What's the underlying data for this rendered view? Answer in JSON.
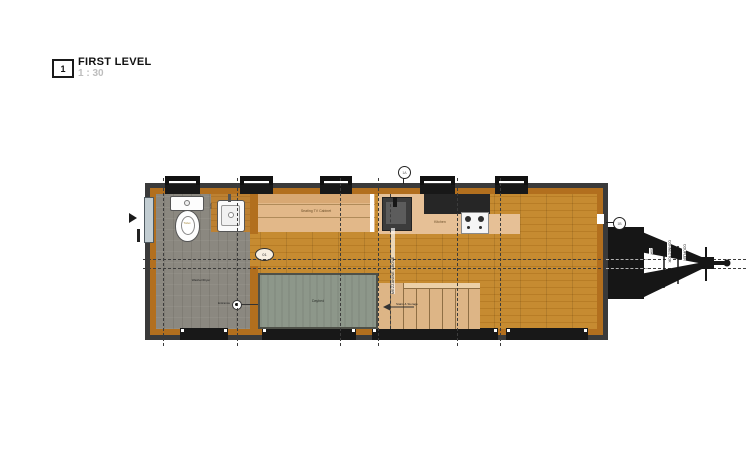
{
  "sheet": {
    "number": "1",
    "title": "FIRST LEVEL",
    "scale": "1 : 30"
  },
  "plan": {
    "labels": {
      "toilet": "Toilet",
      "sink": "Sink",
      "washer_dryer": "Washer/Dryer",
      "entrance": "Entrance",
      "fixture_tag": "01",
      "seating": "Seating TV Cabinet",
      "kitchen": "Kitchen",
      "daybed": "Daybed",
      "stairs": "Stairs & Storage",
      "mezzanine": "MEZZANINE ABOVE"
    },
    "markers": {
      "top": "1A",
      "right": "1B"
    },
    "hitch": {
      "labels": [
        "50A",
        "CONNECTOR",
        "COUPLER"
      ]
    },
    "colors": {
      "wood_floor": "#c1862f",
      "wall_trim": "#b26f1e",
      "wall_core": "#3a3a3a",
      "bath_floor": "#8b8880",
      "counter": "#e6c096",
      "cabinet": "#e2b889",
      "counter_dark": "#262626",
      "daybed": "#8d978a",
      "stairs": "#ddb586",
      "glazing": "#c2cdd2",
      "hitch": "#161616"
    }
  }
}
